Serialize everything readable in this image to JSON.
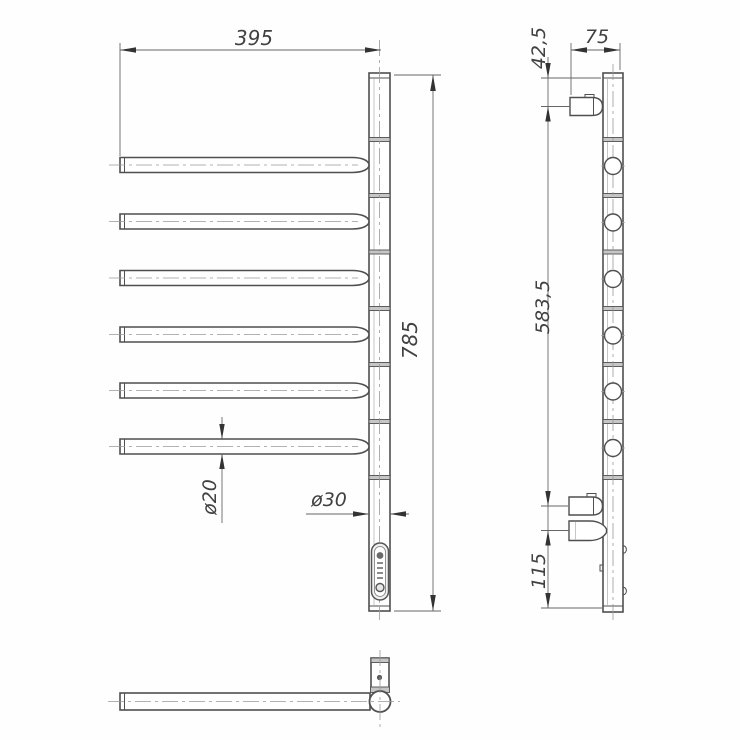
{
  "drawing": {
    "kind": "engineering-drawing: electric towel rail with six swivel arms, three orthographic views",
    "colors": {
      "line": "#4f4f4f",
      "dimension": "#666666",
      "centerline": "#999999",
      "background": "#fefefe"
    },
    "dimensions": {
      "top_width": "395",
      "overall_height": "785",
      "arm_diameter": "ø20",
      "post_diameter": "ø30",
      "side_top_offset": "42,5",
      "side_depth": "75",
      "side_mount_span": "583,5",
      "side_bottom_offset": "115"
    }
  }
}
